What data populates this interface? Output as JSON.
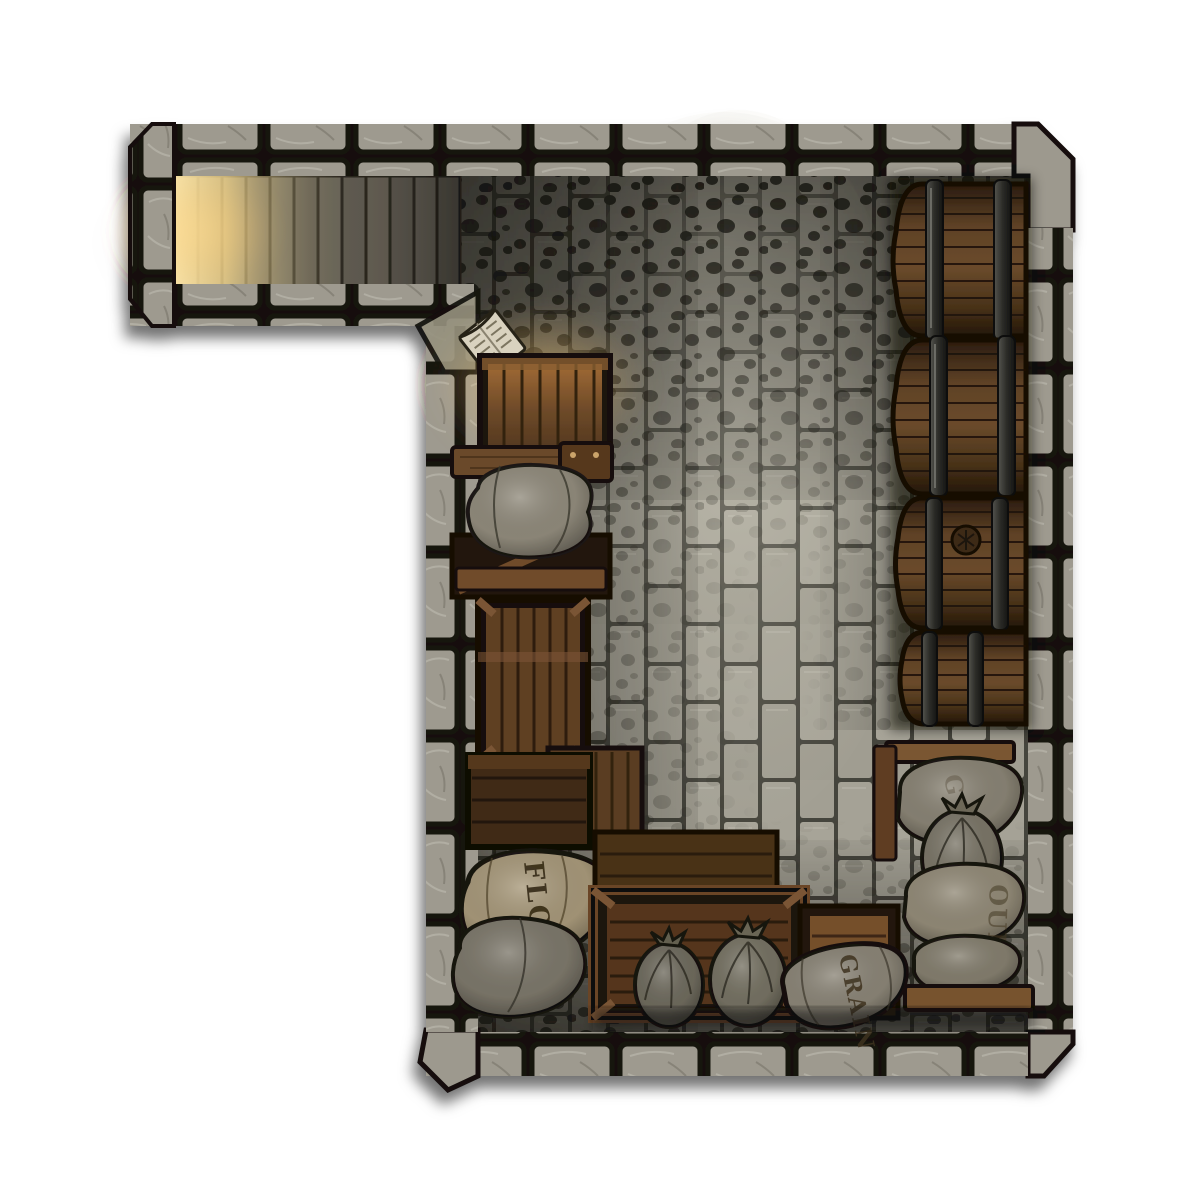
{
  "map": {
    "kind": "top-down dungeon battlemap",
    "room": "stone cellar storeroom with stair corridor",
    "labels": {
      "flour_left": "FLOUR",
      "grain_bottom": "GRAIN",
      "flour_right_partial": "OUR",
      "grain_right_partial": "G"
    },
    "objects": [
      "stairs",
      "open-book",
      "lit-crate",
      "wood-shelf",
      "burlap-sack",
      "open-crate",
      "tall-crate",
      "dark-crate",
      "flour-sack",
      "gray-sack",
      "long-crate",
      "small-crate",
      "tied-sack",
      "tied-sack",
      "grain-sack",
      "barrel",
      "barrel",
      "barrel",
      "barrel",
      "sack-stack",
      "tied-sack"
    ],
    "colors": {
      "wall_stone": "#9e9a8f",
      "wall_grout": "#14120e",
      "floor_brick": "#a5a296",
      "floor_grout": "#45443c",
      "moss_dark": "#1d1c16",
      "wood_mid": "#6b4a2e",
      "wood_dark": "#3f2a16",
      "barrel_wood": "#5f4226",
      "hoop_metal": "#32322e",
      "burlap": "#938b78",
      "flour_tan": "#a8997a",
      "stair_light": "#f5e3a8",
      "label_ink": "#3a2d18"
    }
  }
}
